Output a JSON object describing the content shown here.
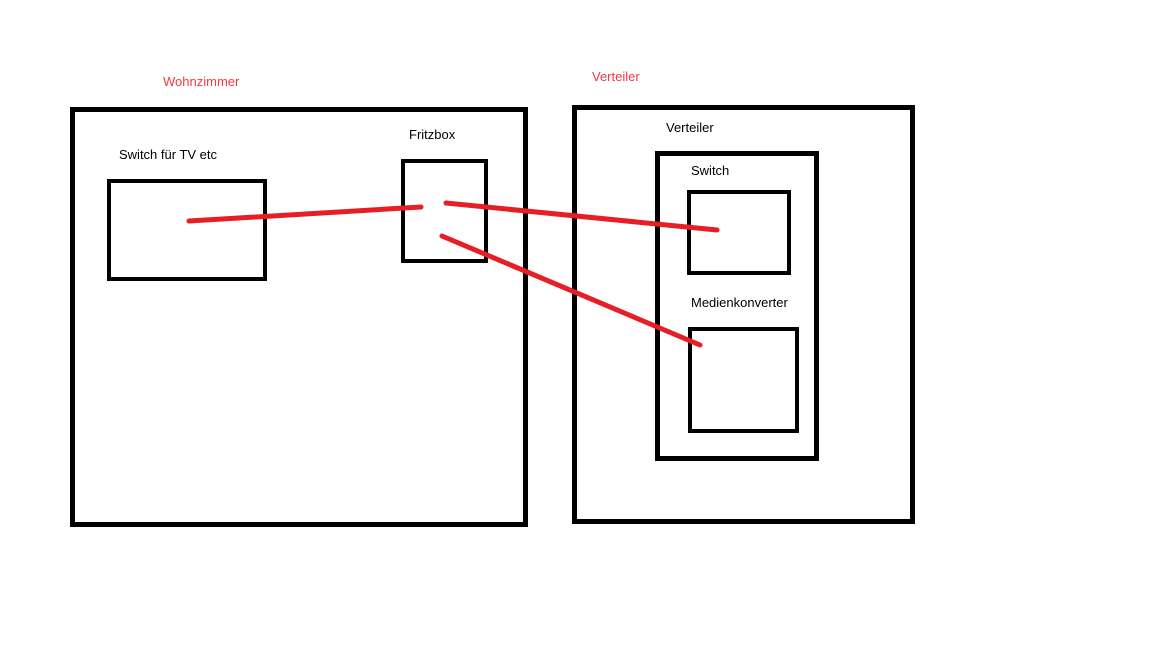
{
  "diagram": {
    "colors": {
      "line": "#e61e25",
      "label_red": "#ee3a42",
      "box_border": "#000000",
      "background": "#ffffff"
    },
    "rooms": {
      "wohnzimmer": {
        "title": "Wohnzimmer",
        "devices": {
          "switch_tv": {
            "label": "Switch für TV etc"
          },
          "fritzbox": {
            "label": "Fritzbox"
          }
        }
      },
      "verteiler": {
        "title": "Verteiler",
        "inner_label": "Verteiler",
        "devices": {
          "switch": {
            "label": "Switch"
          },
          "medienkonverter": {
            "label": "Medienkonverter"
          }
        }
      }
    },
    "connections": [
      {
        "from": "switch-tv",
        "to": "fritzbox",
        "x1": 189,
        "y1": 221,
        "x2": 421,
        "y2": 207
      },
      {
        "from": "fritzbox",
        "to": "verteiler-switch",
        "x1": 446,
        "y1": 203,
        "x2": 717,
        "y2": 230
      },
      {
        "from": "fritzbox",
        "to": "medienkonverter",
        "x1": 442,
        "y1": 236,
        "x2": 700,
        "y2": 345
      }
    ]
  }
}
